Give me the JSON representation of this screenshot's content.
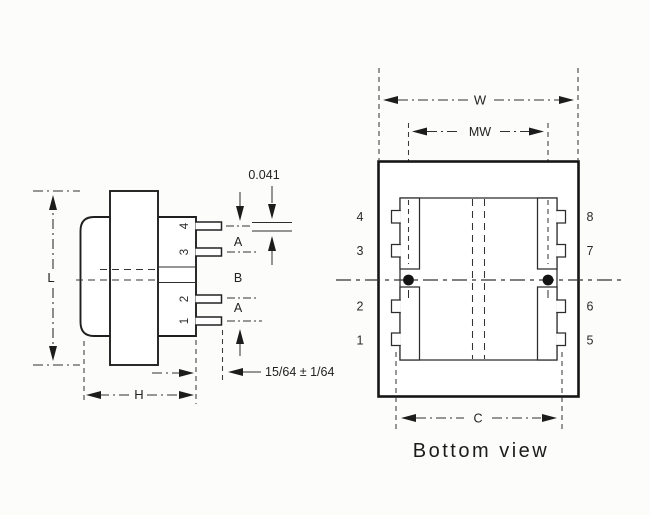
{
  "side_view": {
    "dim_length": "L",
    "dim_height": "H",
    "dim_pin_thickness": "0.041",
    "dim_a_top": "A",
    "dim_b": "B",
    "dim_a_bottom": "A",
    "dim_pin_length": "15/64 ± 1/64",
    "pin_labels": [
      "4",
      "3",
      "2",
      "1"
    ]
  },
  "bottom_view": {
    "title": "Bottom view",
    "dim_width": "W",
    "dim_mount_width": "MW",
    "dim_pin_span": "C",
    "pin_labels_left": [
      "4",
      "3",
      "2",
      "1"
    ],
    "pin_labels_right": [
      "8",
      "7",
      "6",
      "5"
    ]
  },
  "colors": {
    "ink": "#2a2a2a",
    "paper": "#fcfcfa",
    "dot": "#141414"
  }
}
